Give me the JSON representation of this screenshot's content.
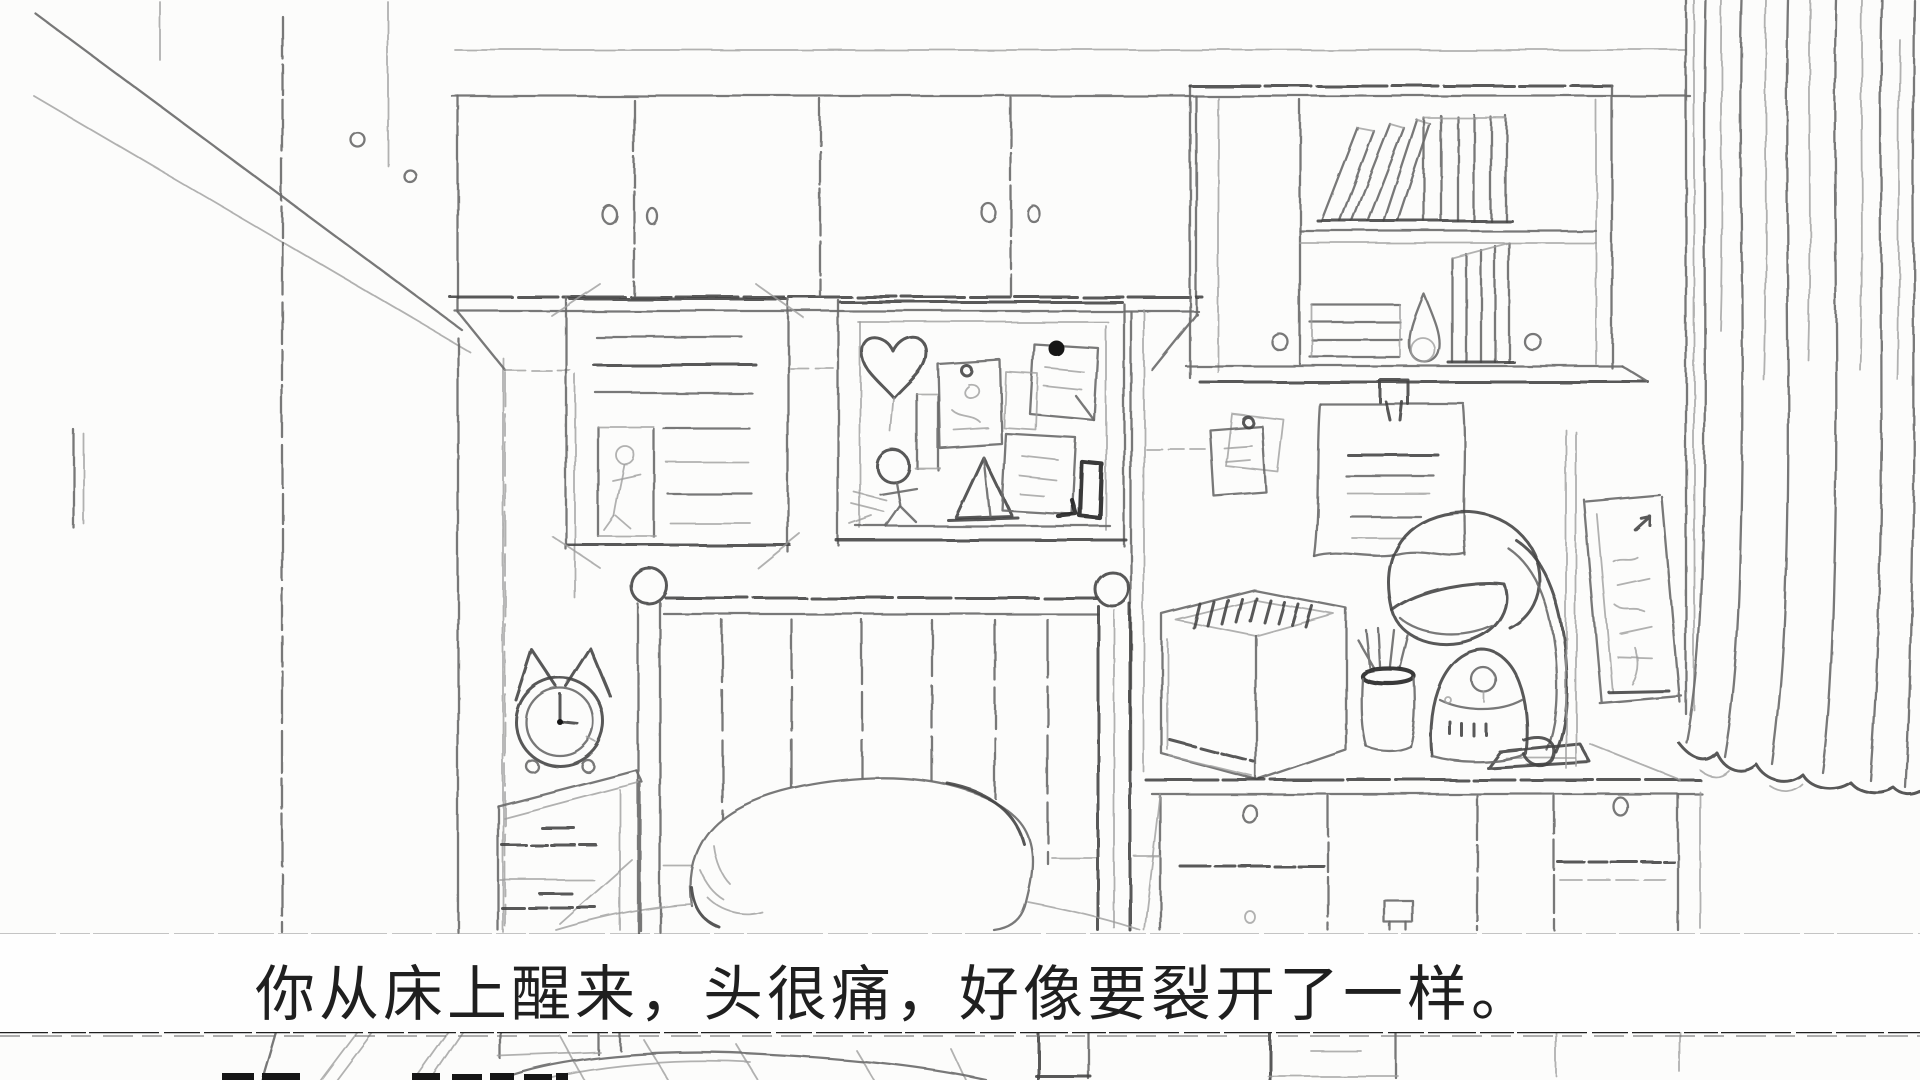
{
  "dialogue": {
    "text": "你从床上醒来，头很痛，好像要裂开了一样。"
  },
  "scene": {
    "style": "hand-drawn pencil sketch, monochrome bedroom",
    "elements": [
      "wardrobe",
      "overhead-cabinets",
      "wall-bookshelf",
      "taped-poster",
      "corkboard",
      "pinned-papers",
      "desk-lamp",
      "robot-figurine",
      "pen-cup",
      "file-organizer",
      "desk-with-drawers",
      "wall-poster",
      "curtain",
      "bed-headboard",
      "pillow",
      "cat-ear-alarm-clock",
      "nightstand",
      "floorboards"
    ]
  },
  "colors": {
    "paper": "#fcfcfb",
    "pencil": "#6a6a6a",
    "pencil_light": "#9e9e9e",
    "pencil_dark": "#454545",
    "textbox_bg": "#fefefe",
    "textbox_border": "#1f1f1f",
    "dialogue_text": "#1f1f1f"
  }
}
